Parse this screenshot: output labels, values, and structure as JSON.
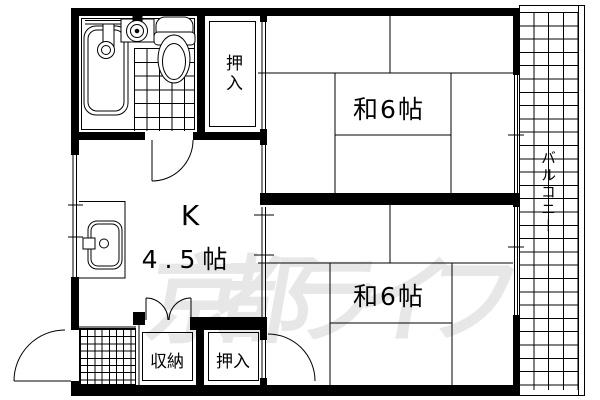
{
  "floor_plan": {
    "labels": {
      "room_upper": "和6帖",
      "room_lower": "和6帖",
      "kitchen_type": "K",
      "kitchen_size": "4.5帖",
      "closet_upper": "押入",
      "closet_lower": "押入",
      "storage": "収納",
      "balcony": "バルコニー"
    },
    "watermark": "京都ライフ",
    "colors": {
      "line": "#000000",
      "wall_fill": "#000000",
      "background": "#ffffff",
      "watermark": "#e7e7e7"
    }
  }
}
